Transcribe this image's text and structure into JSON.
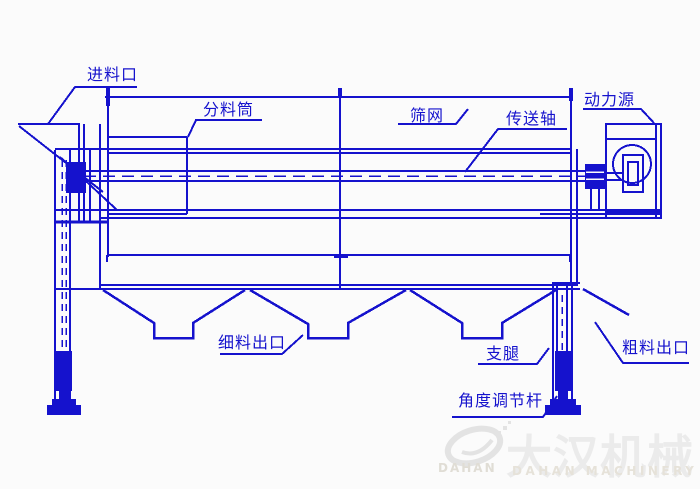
{
  "diagram": {
    "type": "engineering-line-drawing",
    "subject": "trommel drum screening machine side view",
    "colors": {
      "line": "#1512cd",
      "background": "#fbfbfb",
      "watermark_gray": "#e7e7e7"
    },
    "labels": {
      "feed_inlet": "进料口",
      "distributor_drum": "分料筒",
      "screen_mesh": "筛网",
      "transmission_shaft": "传送轴",
      "power_source": "动力源",
      "fine_material_outlet": "细料出口",
      "support_leg": "支腿",
      "coarse_material_outlet": "粗料出口",
      "angle_adjust_rod": "角度调节杆"
    },
    "watermark": {
      "logo": "swirl-ellipse-logo",
      "logo_text": "DAHAN",
      "name_cn": "大汉机械",
      "name_en": "DAHAN MACHINERY"
    }
  }
}
